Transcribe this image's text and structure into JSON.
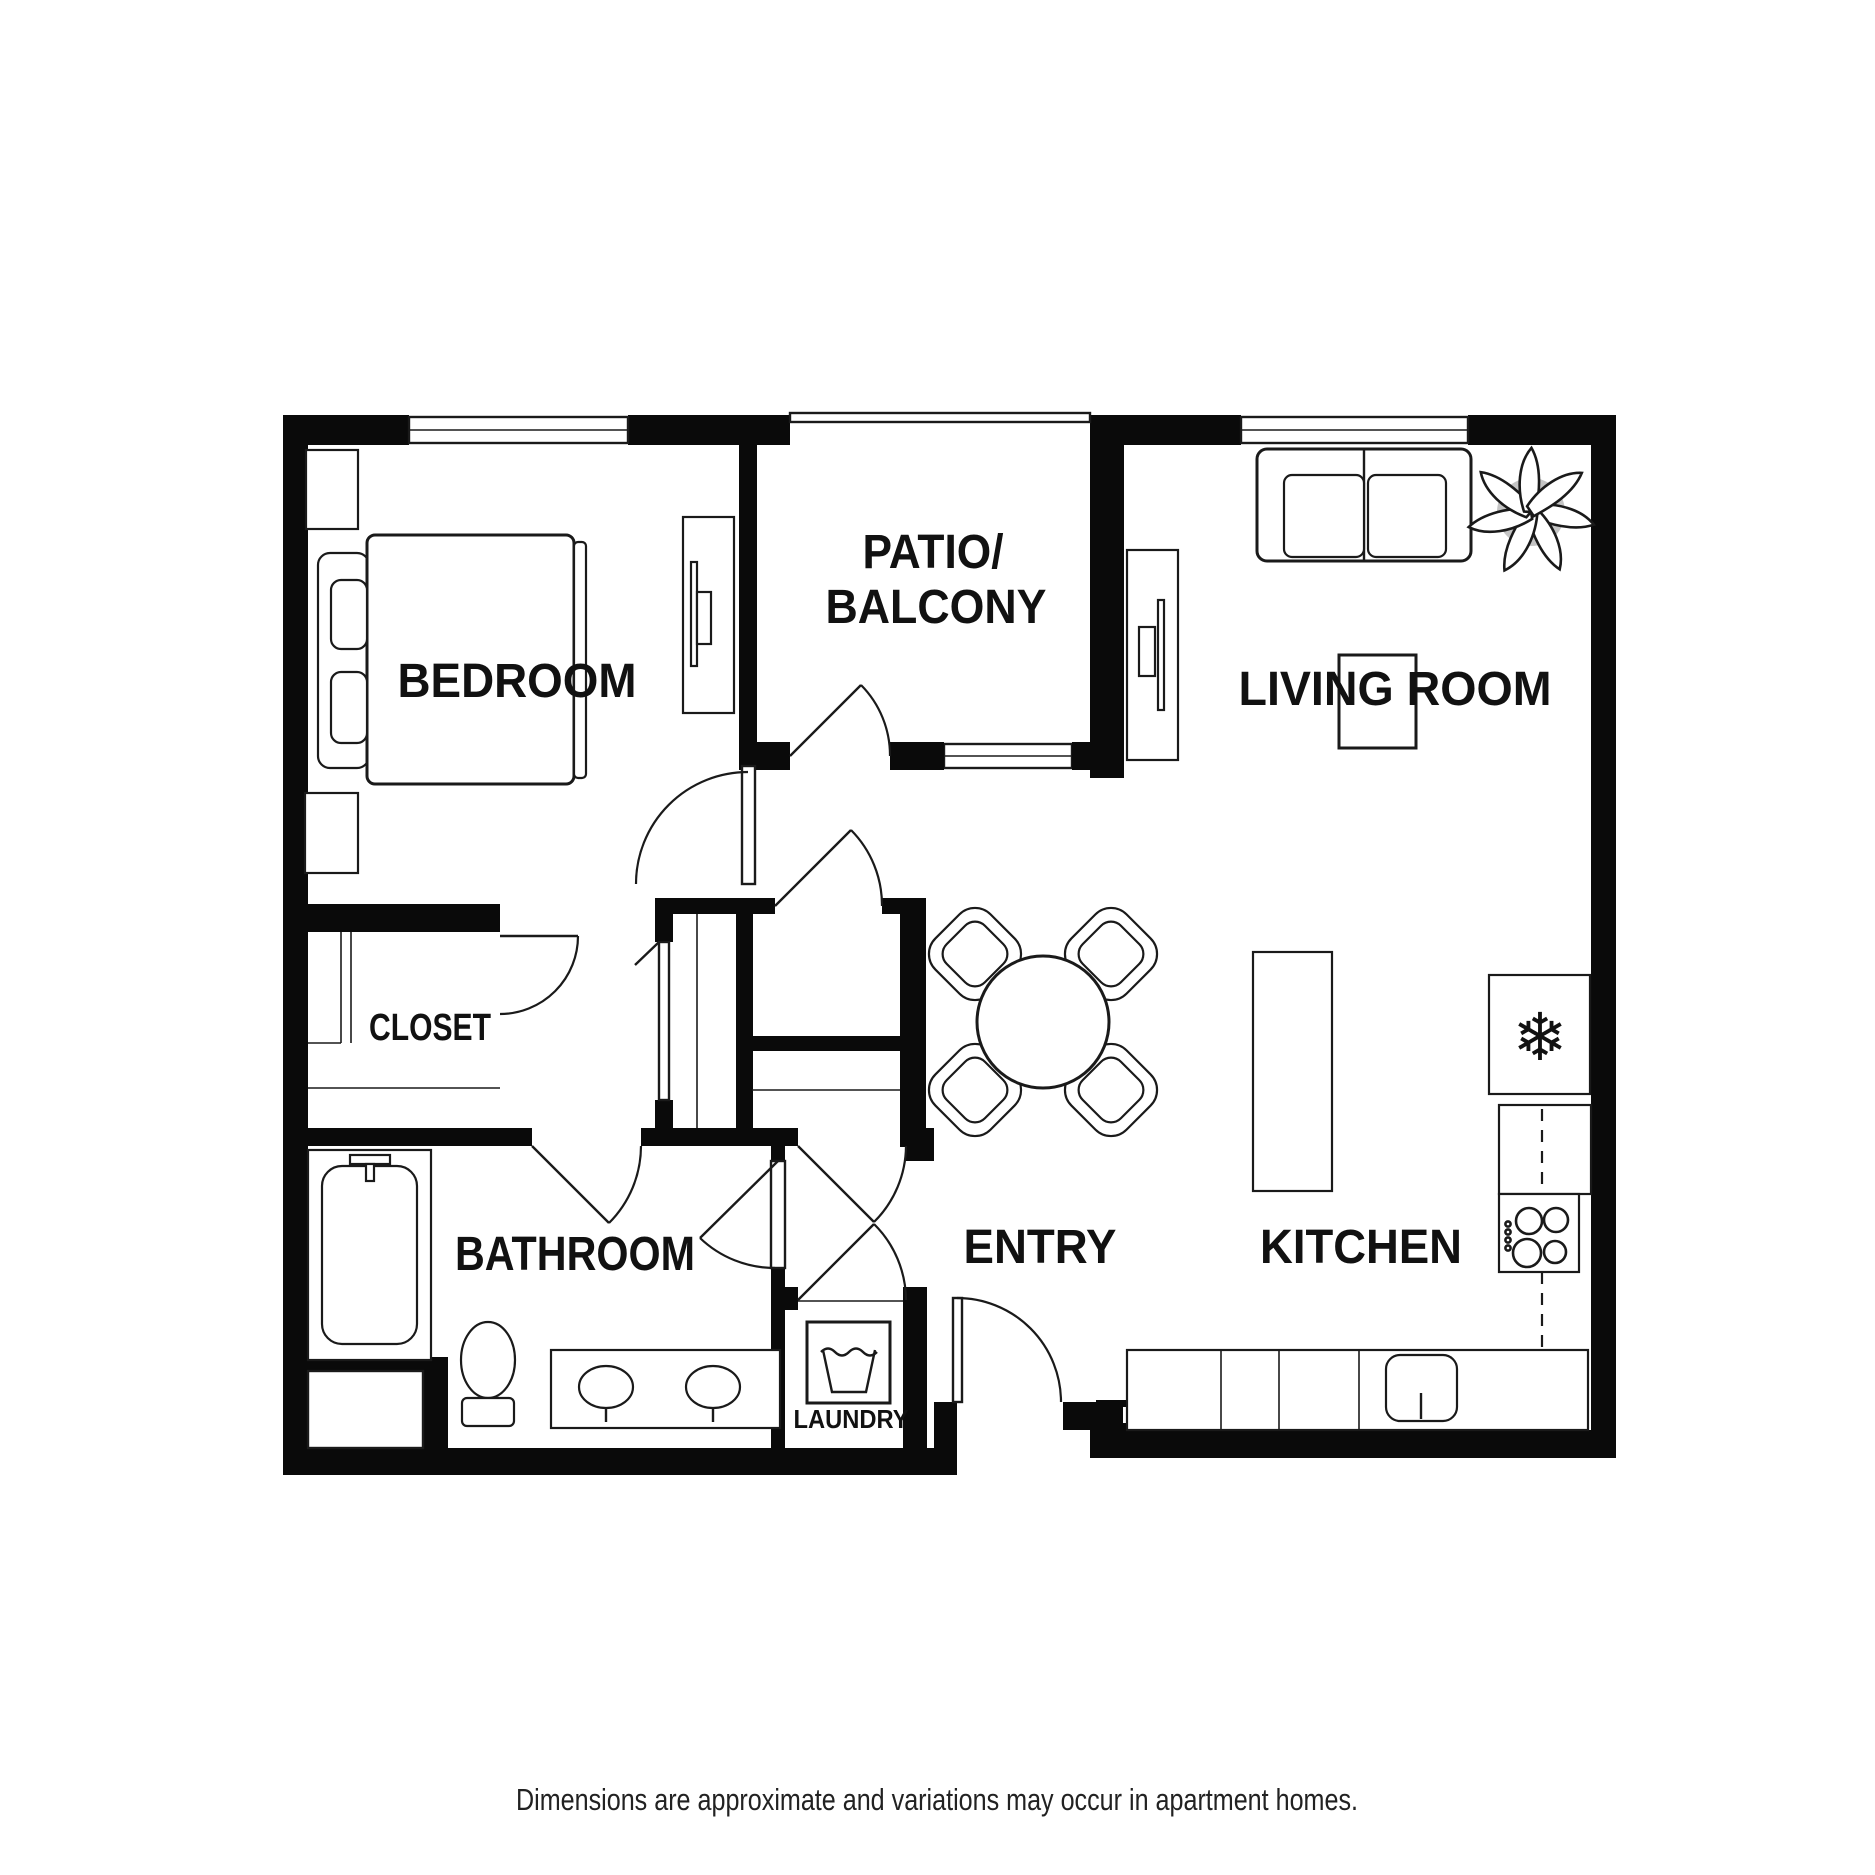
{
  "document": {
    "type": "apartment-floor-plan",
    "disclaimer": "Dimensions are approximate and variations may occur in apartment homes."
  },
  "rooms": {
    "bedroom": {
      "label": "BEDROOM"
    },
    "patio": {
      "label_line1": "PATIO/",
      "label_line2": "BALCONY"
    },
    "living_room": {
      "label": "LIVING ROOM"
    },
    "closet": {
      "label": "CLOSET"
    },
    "bathroom": {
      "label": "BATHROOM"
    },
    "entry": {
      "label": "ENTRY"
    },
    "kitchen": {
      "label": "KITCHEN"
    },
    "laundry": {
      "label": "LAUNDRY"
    }
  },
  "icons": {
    "fridge_snowflake": "❄",
    "washer_symbol": "wash-tub-icon",
    "plant_symbol": "potted-plant-icon"
  },
  "colors": {
    "background": "#ffffff",
    "walls": "#0a0a0a",
    "line_work": "#1a1a1a",
    "plant_pot": "#c4c4c4",
    "label_text": "#111111"
  }
}
